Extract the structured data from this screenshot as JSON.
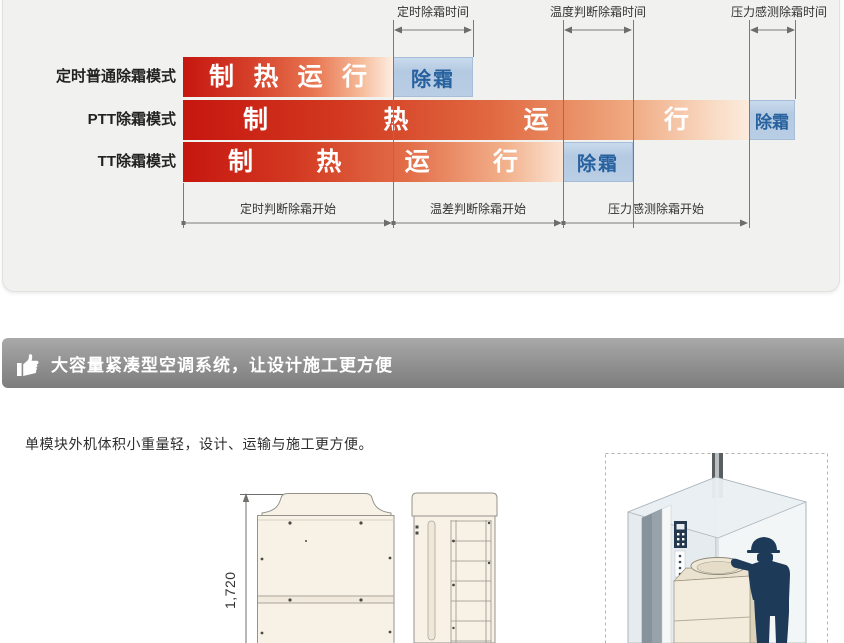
{
  "defrost_panel": {
    "top_dimensions": [
      {
        "label": "定时除霜时间"
      },
      {
        "label": "温度判断除霜时间"
      },
      {
        "label": "压力感测除霜时间"
      }
    ],
    "rows": [
      {
        "mode": "定时普通除霜模式",
        "heating": "制 热 运 行",
        "defrost": "除霜"
      },
      {
        "mode": "PTT除霜模式",
        "heating": "制 热 运 行",
        "defrost": "除霜"
      },
      {
        "mode": "TT除霜模式",
        "heating": "制 热 运 行",
        "defrost": "除霜"
      }
    ],
    "bottom_phases": [
      {
        "label": "定时判断除霜开始"
      },
      {
        "label": "温差判断除霜开始"
      },
      {
        "label": "压力感测除霜开始"
      }
    ],
    "colors": {
      "heating_start": "#c6160f",
      "heating_end": "#fdeee2",
      "defrost_bg": "#b9cee5",
      "defrost_text": "#27619e",
      "panel_bg": "#f1f1ef"
    }
  },
  "section2": {
    "title": "大容量紧凑型空调系统，让设计施工更方便",
    "description": "单模块外机体积小重量轻，设计、运输与施工更方便。",
    "header_bg": "#8e8e8e",
    "drawing": {
      "height_label": "1,720"
    }
  }
}
